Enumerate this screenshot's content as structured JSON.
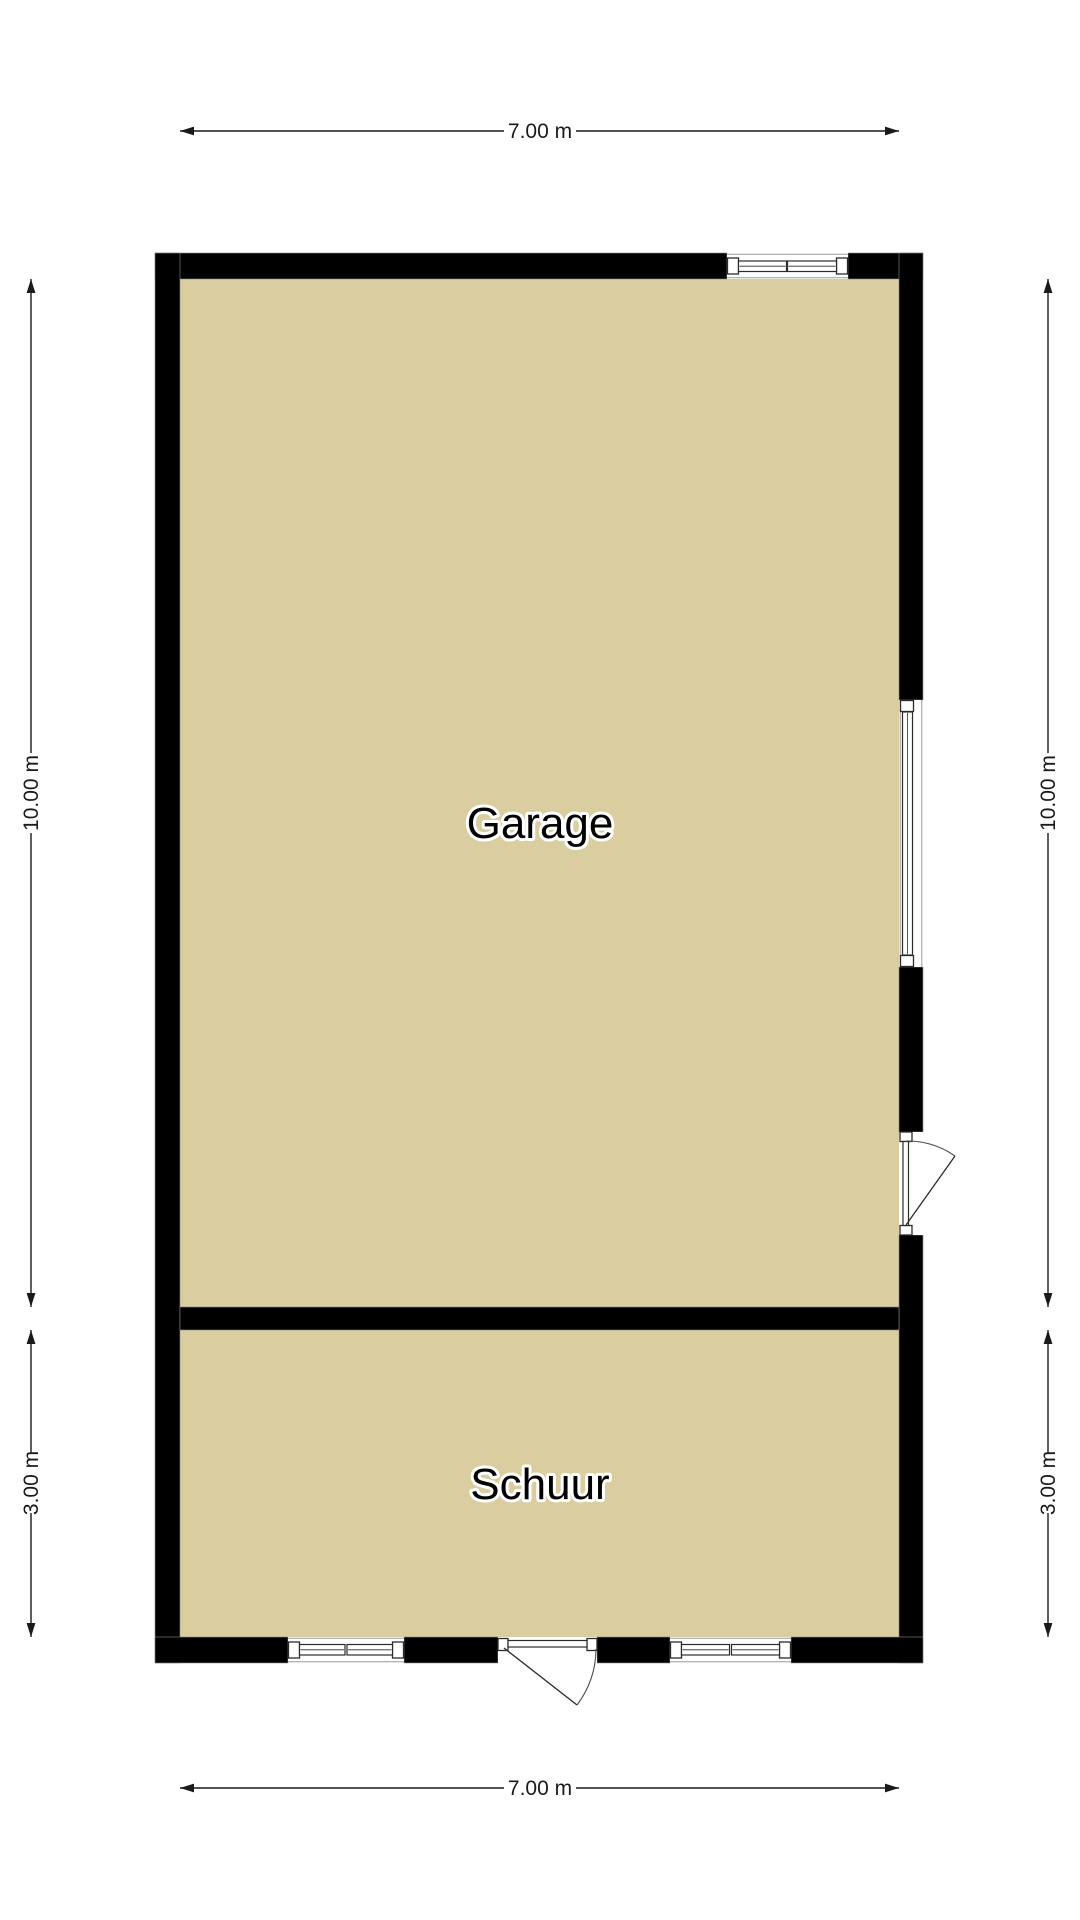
{
  "rooms": {
    "garage": "Garage",
    "schuur": "Schuur"
  },
  "dimensions": {
    "top_width": "7.00 m",
    "bottom_width": "7.00 m",
    "left_upper": "10.00 m",
    "right_upper": "10.00 m",
    "left_lower": "3.00 m",
    "right_lower": "3.00 m"
  },
  "colors": {
    "floor": "#dacda0",
    "wall": "#000000",
    "dimension": "#1a1a1a",
    "background": "#ffffff"
  }
}
